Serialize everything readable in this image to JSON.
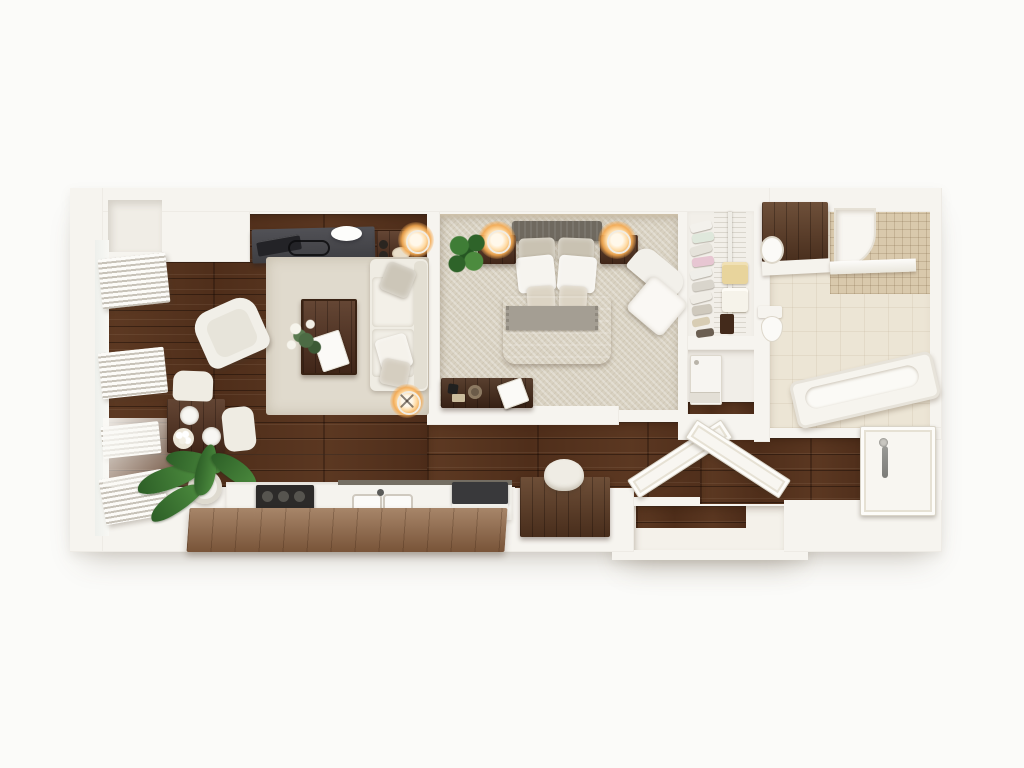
{
  "title": "apartment-3d-floor-plan",
  "palette": {
    "bg": "#fbfbf9",
    "wall": "#f6f4ef",
    "wall-shade": "#e7e2d9",
    "wood-mid": "#55321d",
    "island-wood": "#8a6243",
    "walnut": "#4f3020",
    "carpet": "#d8d1c1",
    "rug": "#e0dacd",
    "tile": "#ece5d5",
    "mosaic": "#d9c9ac",
    "cream": "#efece3",
    "desk-gray": "#47474b",
    "lamp-glow": "#f5a94f",
    "leaf-green": "#3c7a36"
  },
  "rooms": {
    "living_dining": [
      "window-blinds x4",
      "wall-niche",
      "desk-console",
      "laptop",
      "serving-tray",
      "decor-bowl",
      "side-table",
      "table-lamp",
      "sofa",
      "sofa-pillows x3",
      "area-rug",
      "coffee-table",
      "flower-arrangement",
      "magazine",
      "armchair",
      "floor-lamp",
      "dining-table",
      "dinner-plates x3",
      "dining-chair x2",
      "potted-plant"
    ],
    "kitchen": [
      "counter",
      "cooktop",
      "double-sink",
      "faucet",
      "coffee-station",
      "island-bar"
    ],
    "office_nook": [
      "desk",
      "office-chair"
    ],
    "bedroom": [
      "headboard",
      "pillows x6",
      "duvet",
      "throw-blanket",
      "nightstand x2",
      "bedside-lamp x2",
      "potted-plant",
      "dresser",
      "decor-items",
      "magazine",
      "corner-lounge-chair"
    ],
    "walk_in_closet": [
      "wire-shelving",
      "hanging-clothes x8",
      "folded-towels x2",
      "storage-box",
      "shoes x2"
    ],
    "laundry": [
      "washer"
    ],
    "bathroom": [
      "vanity",
      "vanity-sink",
      "toilet",
      "shower",
      "mosaic-tile-surround",
      "glass-panel",
      "bathtub"
    ],
    "hallway": [
      "open-door x2",
      "entry-niche",
      "front-door",
      "door-handle"
    ]
  }
}
